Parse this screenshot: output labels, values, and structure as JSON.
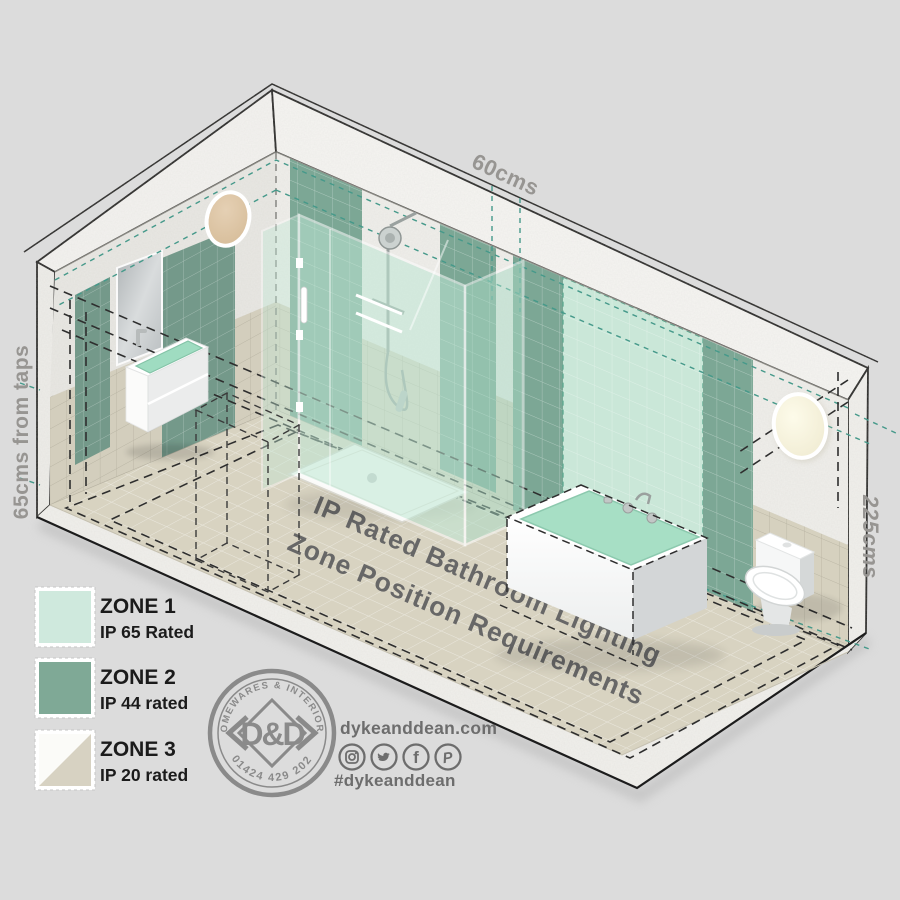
{
  "dimensions": {
    "top": "60cms",
    "left": "65cms from taps",
    "right": "225cms"
  },
  "floor_title": {
    "line1": "IP Rated Bathroom Lighting",
    "line2": "Zone Position Requirements"
  },
  "legend": {
    "items": [
      {
        "zone": "ZONE 1",
        "rating": "IP 65 Rated",
        "swatch": "#cfe9dd"
      },
      {
        "zone": "ZONE 2",
        "rating": "IP 44 rated",
        "swatch": "#7fa996"
      },
      {
        "zone": "ZONE 3",
        "rating": "IP 20 rated",
        "swatch_top": "#fbfbf8",
        "swatch_bottom": "#d7d2c2"
      }
    ]
  },
  "logo": {
    "arc_top": "HOMEWARES & INTERIORS",
    "arc_bottom": "01424 429 202",
    "monogram": "D&D"
  },
  "contact": {
    "website": "dykeanddean.com",
    "hashtag": "#dykeanddean",
    "social": [
      {
        "name": "instagram-icon",
        "glyph": ""
      },
      {
        "name": "twitter-icon",
        "glyph": ""
      },
      {
        "name": "facebook-icon",
        "glyph": "f"
      },
      {
        "name": "pinterest-icon",
        "glyph": "P"
      }
    ]
  },
  "colors": {
    "zone1_mint": "#cfe9dd",
    "zone2_green": "#7fa996",
    "zone3_beige": "#d7d2c2",
    "teal_dash": "#45998a",
    "dash_black": "#2e2e2e",
    "dimension_gray": "#979592",
    "floor_text_gray": "#676767",
    "logo_gray": "#8a8a8a",
    "contact_gray": "#6d6d6d",
    "wall_light_left": "#dcc3a4",
    "wall_light_right": "#f7f3dd"
  }
}
